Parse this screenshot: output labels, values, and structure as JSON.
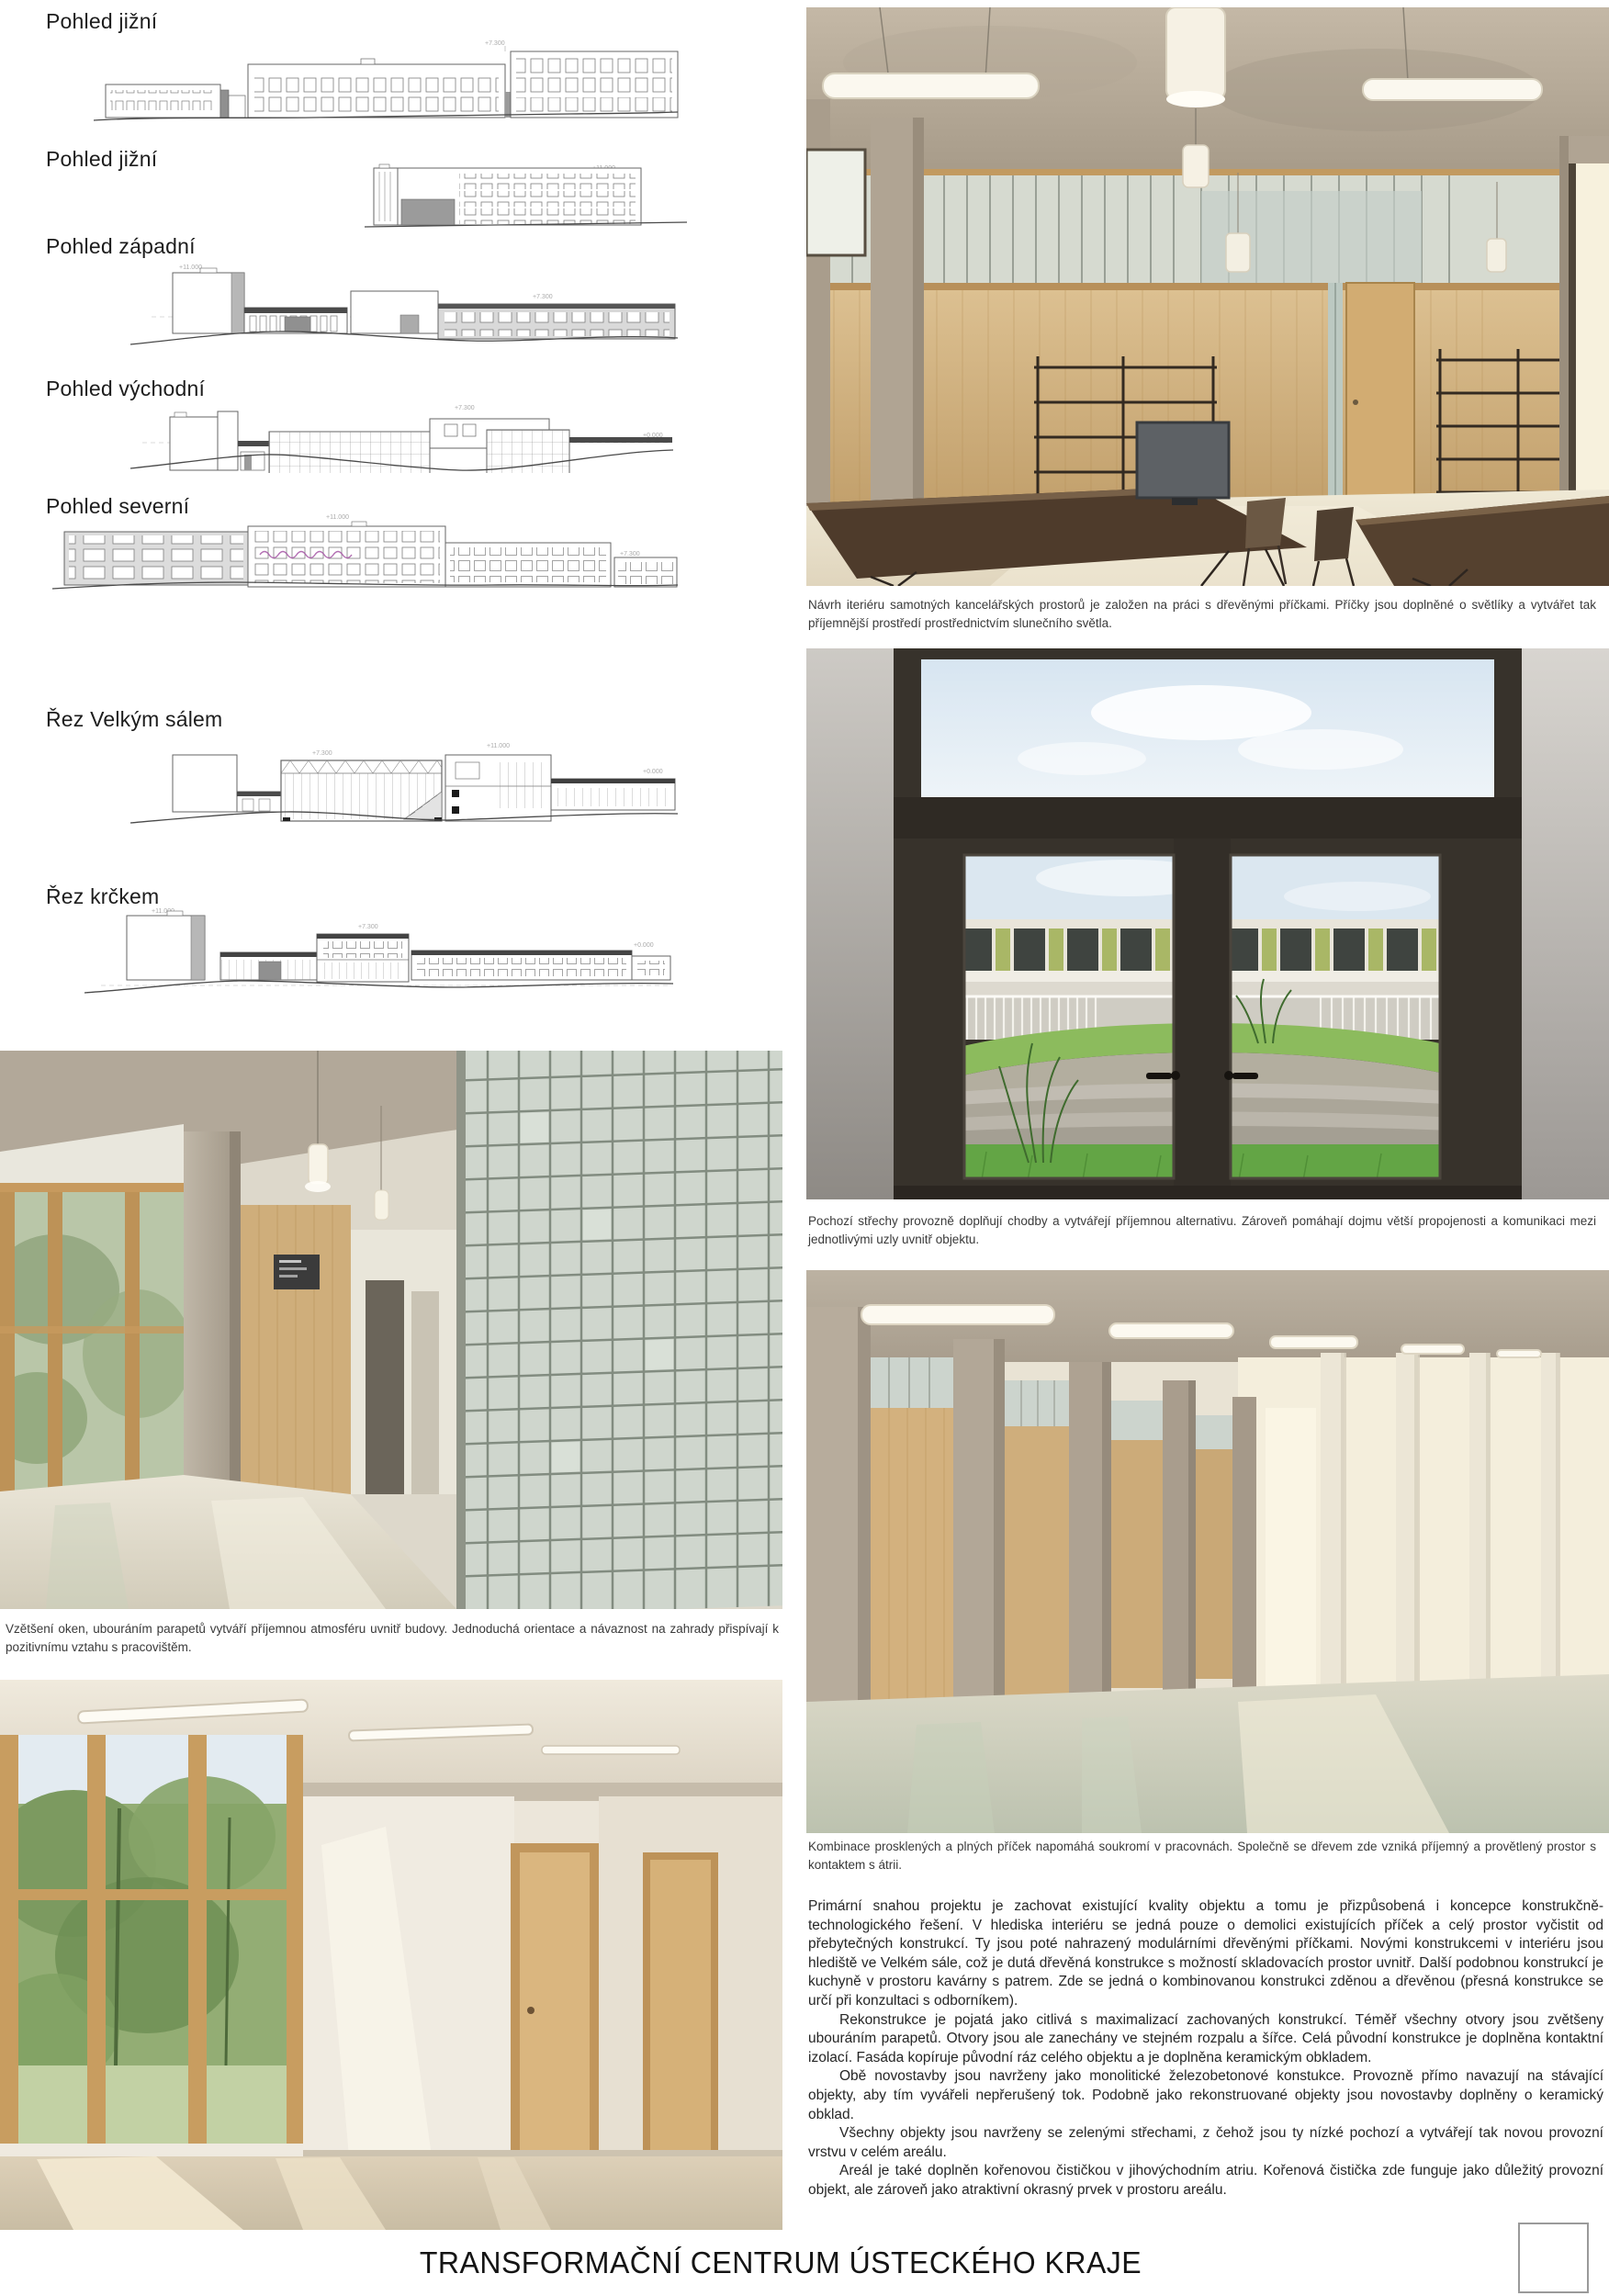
{
  "page": {
    "title": "TRANSFORMAČNÍ CENTRUM ÚSTECKÉHO KRAJE"
  },
  "drawings": {
    "items": [
      {
        "label": "Pohled jižní"
      },
      {
        "label": "Pohled jižní"
      },
      {
        "label": "Pohled západní"
      },
      {
        "label": "Pohled východní"
      },
      {
        "label": "Pohled severní"
      },
      {
        "label": "Řez Velkým sálem"
      },
      {
        "label": "Řez krčkem"
      }
    ],
    "marks": [
      "+11.000",
      "+7.300",
      "+0.000"
    ]
  },
  "captions": {
    "office": "Návrh iteriéru samotných kancelářských prostorů je založen na práci s dřevěnými příčkami. Příčky jsou doplněné o světlíky a vytvářet tak příjemnější prostředí prostřednictvím slunečního světla.",
    "roofs": "Pochozí střechy provozně doplňují chodby a vytvářejí příjemnou alternativu. Zároveň pomáhají dojmu větší propojenosti a komunikaci mezi jednotlivými uzly uvnitř objektu.",
    "windows": "Vzětšení oken, ubouráním parapetů vytváří příjemnou atmosféru uvnitř budovy. Jednoduchá orientace a návaznost na zahrady přispívají k pozitivnímu vztahu s pracovištěm.",
    "partitions": "Kombinace prosklených a plných příček napomáhá soukromí v pracovnách. Společně se dřevem zde vzniká příjemný a provětlený prostor s kontaktem s átrii."
  },
  "body": {
    "paragraphs": [
      "Primární snahou projektu je zachovat existující kvality objektu a tomu je přizpůsobená i koncepce konstrukčně-technologického řešení. V hlediska interiéru se jedná pouze o demolici existujících příček a celý prostor vyčistit od přebytečných konstrukcí. Ty jsou poté nahrazený modulárními dřevěnými příčkami. Novými konstrukcemi v interiéru jsou hlediště ve Velkém sále, což je dutá dřevěná konstrukce s možností skladovacích prostor uvnitř. Další podobnou konstrukcí je kuchyně v prostoru kavárny s patrem. Zde se jedná o kombinovanou konstrukci zděnou a dřevěnou (přesná konstrukce se určí při konzultaci s odborníkem).",
      "Rekonstrukce je pojatá jako citlivá s maximalizací zachovaných konstrukcí. Téměř všechny otvory jsou zvětšeny ubouráním parapetů. Otvory jsou ale zanechány ve stejném rozpalu a šířce. Celá původní konstrukce je doplněna kontaktní izolací. Fasáda kopíruje původní ráz celého objektu a je doplněna keramickým obkladem.",
      "Obě novostavby jsou navrženy jako monolitické železobetonové konstukce. Provozně přímo navazují na stávající objekty, aby tím vyvářeli nepřerušený tok. Podobně jako rekonstruované objekty jsou novostavby doplněny o keramický obklad.",
      "Všechny objekty jsou navrženy se zelenými střechami, z čehož jsou ty nízké pochozí a vytvářejí tak novou provozní vrstvu v celém areálu.",
      "Areál je také doplněn kořenovou čističkou v jihovýchodním atriu. Kořenová čistička zde funguje jako důležitý provozní objekt, ale zároveň jako atraktivní okrasný prvek v prostoru areálu."
    ]
  }
}
